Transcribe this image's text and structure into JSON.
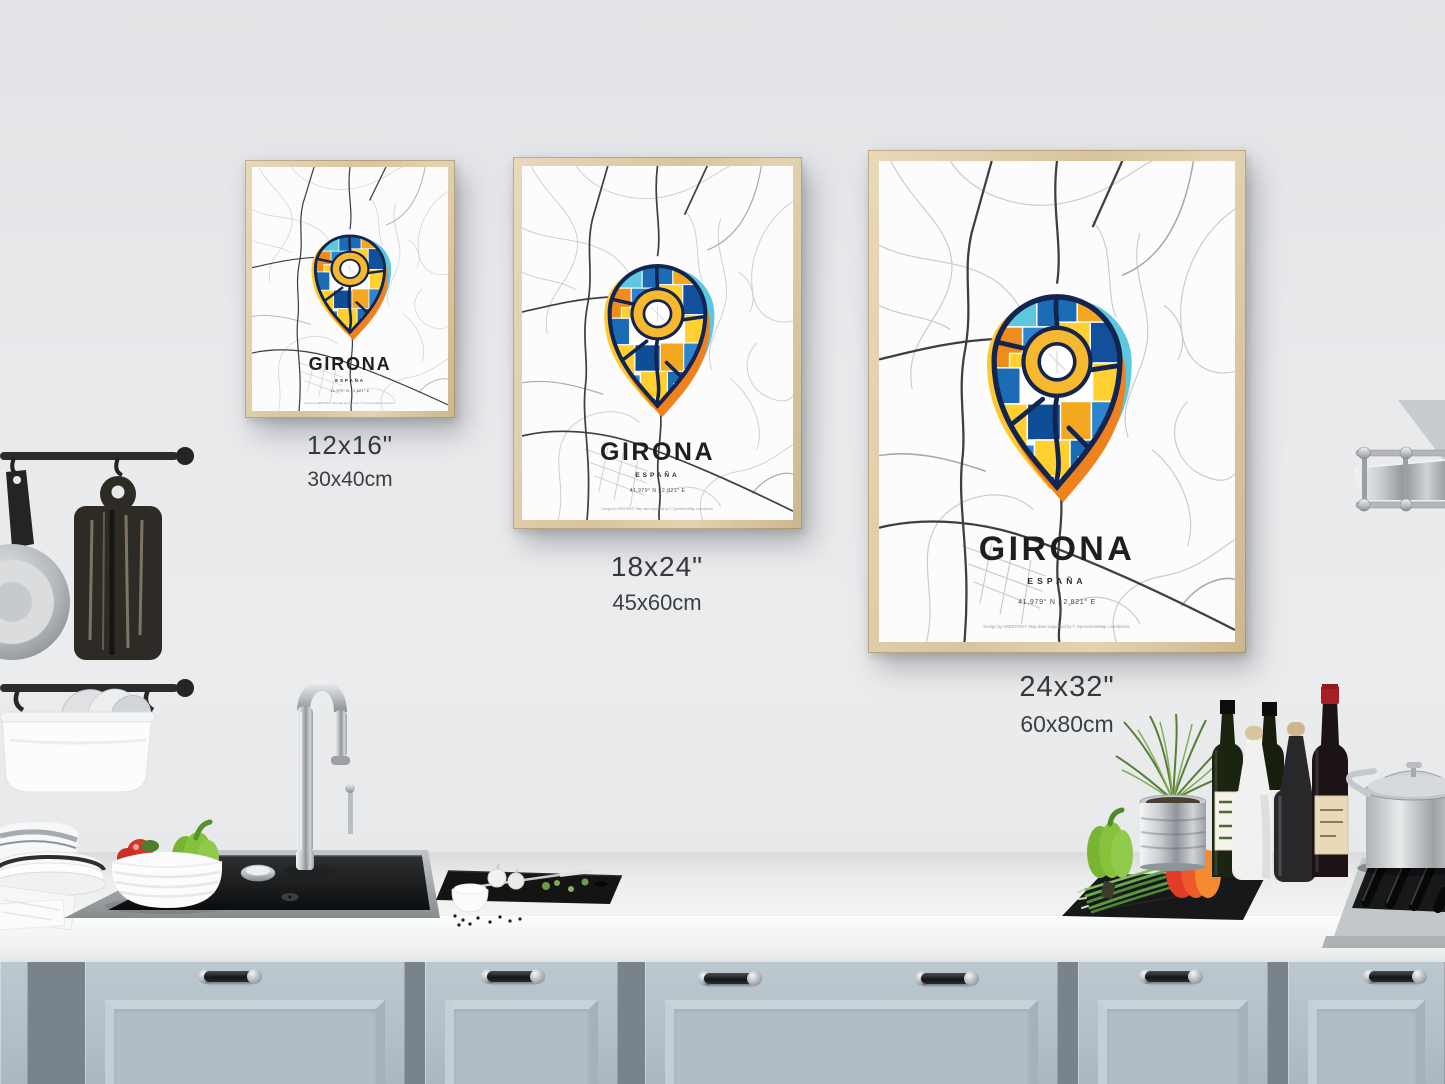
{
  "poster": {
    "title": "GIRONA",
    "country": "ESPAÑA",
    "coordinates": "41,979° N | 2,821° E",
    "attribution": "Design by HEBSTREIT. Map data supported by © OpenStreetMap contributors."
  },
  "size_labels": [
    {
      "inches": "12x16\"",
      "cm": "30x40cm"
    },
    {
      "inches": "18x24\"",
      "cm": "45x60cm"
    },
    {
      "inches": "24x32\"",
      "cm": "60x80cm"
    }
  ],
  "colors": {
    "wall": "#e9eaec",
    "cabinet": "#b5c1ca",
    "frame_wood": "#dcc9a7",
    "pin_blue": "#1b6cb5",
    "pin_dark_blue": "#0f4d96",
    "pin_orange": "#f08c1e",
    "pin_yellow": "#ffd02f",
    "pin_cyan": "#5ec7e0",
    "pin_outline": "#13244e",
    "ring_yellow": "#f5b82e"
  }
}
